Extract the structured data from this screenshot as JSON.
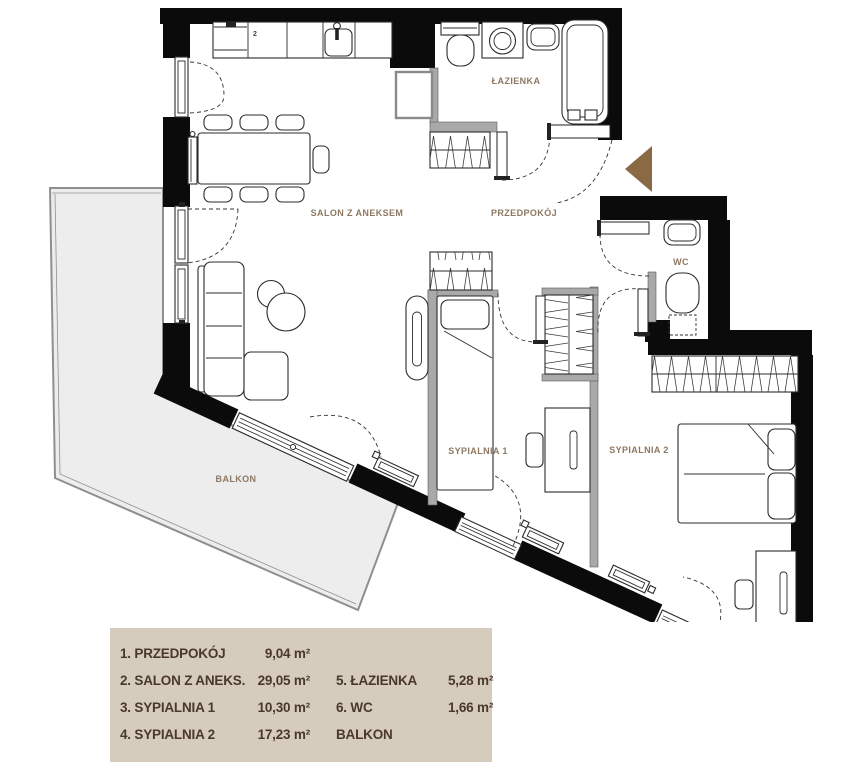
{
  "plan": {
    "rooms": [
      {
        "id": "salon",
        "label": "SALON Z ANEKSEM"
      },
      {
        "id": "przedpokoj",
        "label": "PRZEDPOKÓJ"
      },
      {
        "id": "lazienka",
        "label": "ŁAZIENKA"
      },
      {
        "id": "wc",
        "label": "WC"
      },
      {
        "id": "sypialnia1",
        "label": "SYPIALNIA 1"
      },
      {
        "id": "sypialnia2",
        "label": "SYPIALNIA 2"
      },
      {
        "id": "balkon",
        "label": "BALKON"
      }
    ],
    "kitchen_unit_number": "2",
    "colors": {
      "wall": "#0b0b0b",
      "partition": "#a9a9a9",
      "balcony_fill": "#ededed",
      "balcony_stroke": "#8f8f8f",
      "room_label": "#8d7862",
      "entrance_arrow": "#8a6a45",
      "legend_bg": "#d6ccbe",
      "legend_text": "#4a392a"
    }
  },
  "legend": {
    "rows": [
      {
        "name1": "1. PRZEDPOKÓJ",
        "area1": "9,04 m²",
        "name2": "",
        "area2": ""
      },
      {
        "name1": "2. SALON Z ANEKS.",
        "area1": "29,05 m²",
        "name2": "5. ŁAZIENKA",
        "area2": "5,28 m²"
      },
      {
        "name1": "3. SYPIALNIA 1",
        "area1": "10,30 m²",
        "name2": "6. WC",
        "area2": "1,66 m²"
      },
      {
        "name1": "4. SYPIALNIA 2",
        "area1": "17,23 m²",
        "name2": "BALKON",
        "area2": ""
      }
    ]
  }
}
